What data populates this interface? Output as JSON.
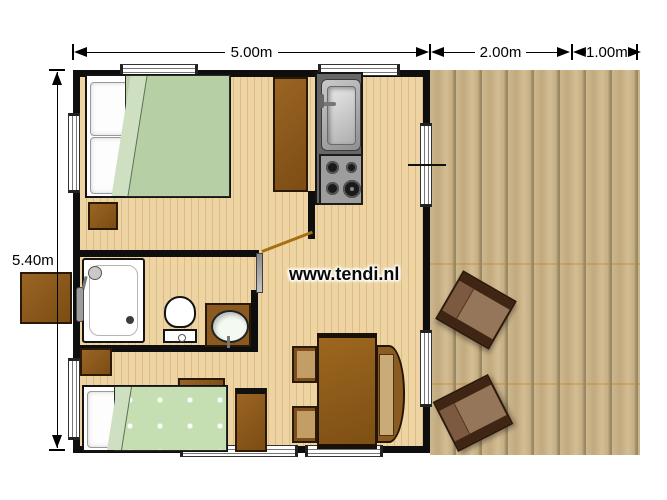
{
  "watermark": "www.tendi.nl",
  "dimensions": {
    "cabin_width": "5.00m",
    "terrace_width": "2.00m",
    "terrace_extension": "1.00m",
    "cabin_height": "5.40m"
  },
  "colors": {
    "wall": "#0e0e0e",
    "cabin_floor": "#eed4a2",
    "terrace_wood": "#c2aa7f",
    "double_bed_duvet": "#b7cfa4",
    "single_bed_duvet": "#c6dfb2",
    "furniture_brown": "#8a551c",
    "kitchen_gray": "#676767",
    "dimension_text": "#000000"
  }
}
